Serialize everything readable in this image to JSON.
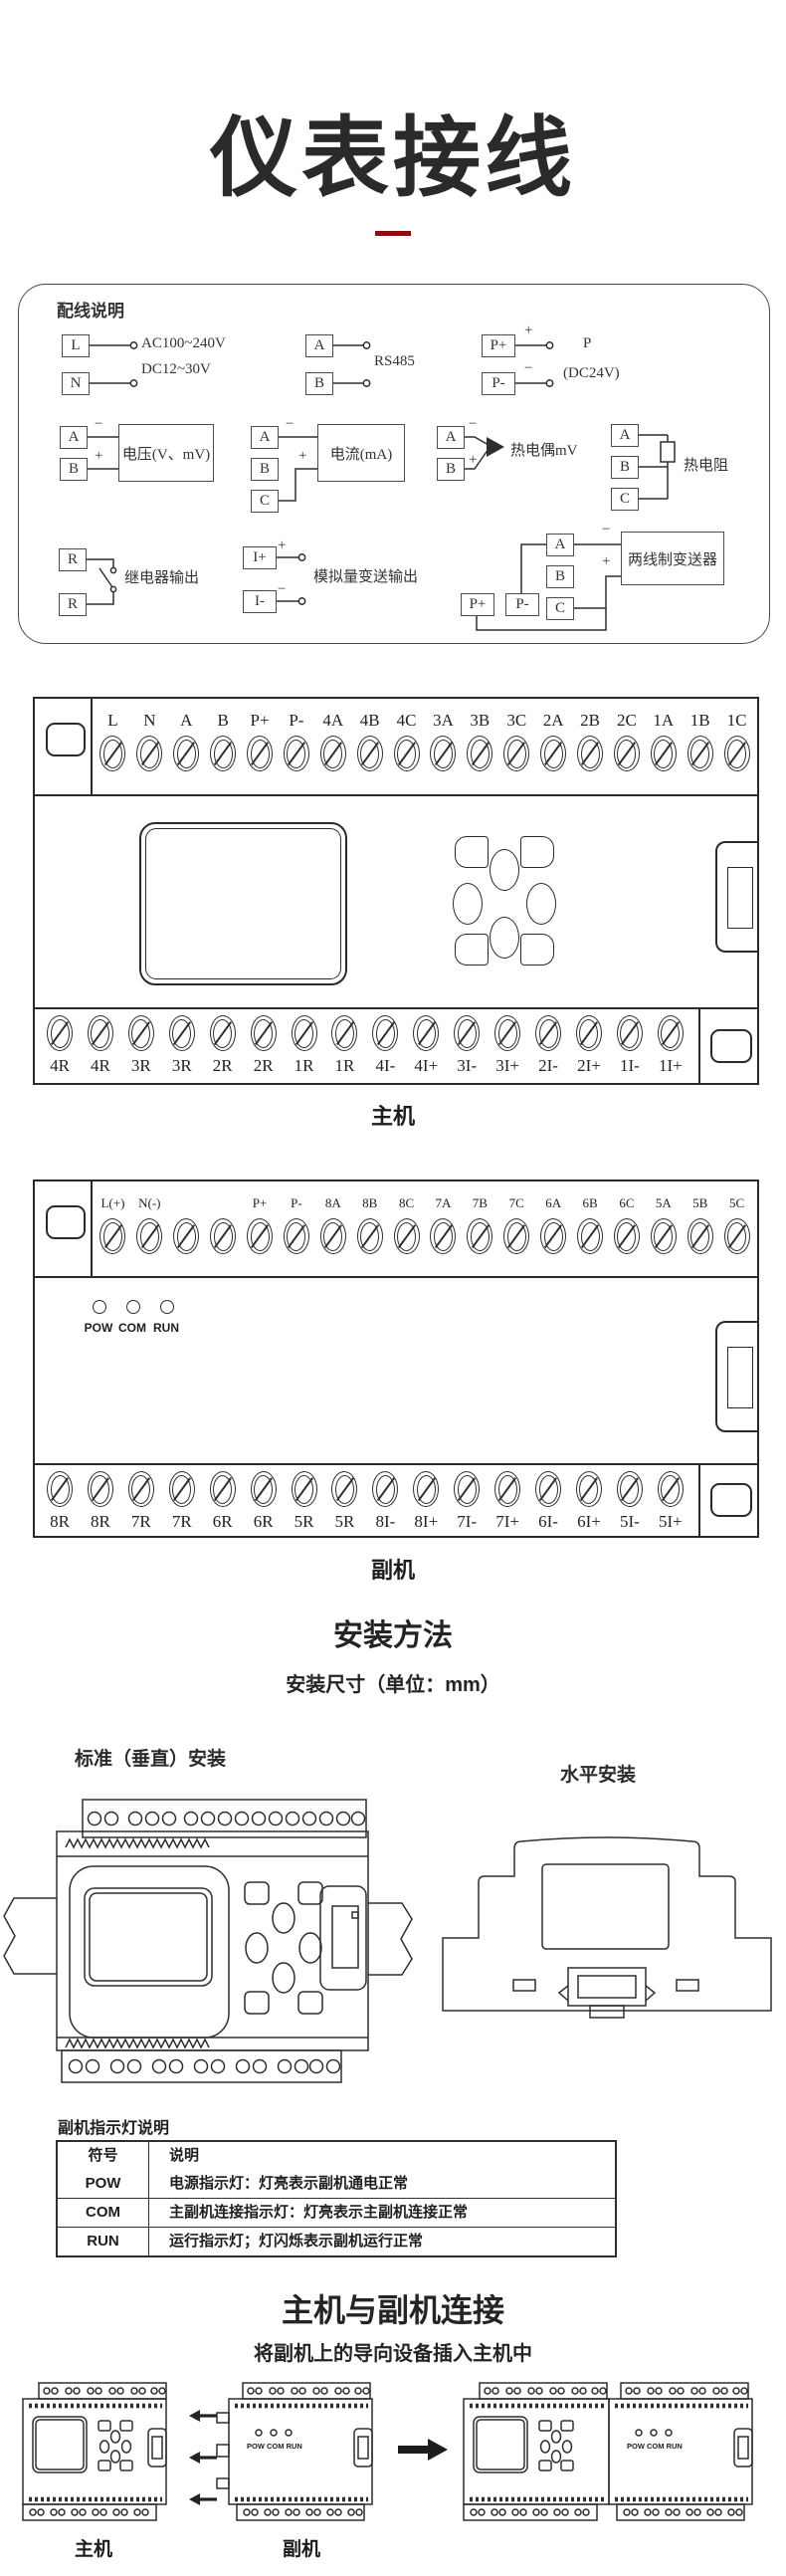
{
  "colors": {
    "accent_red": "#8e0c0c",
    "ink": "#2e2e2e"
  },
  "title": "仪表接线",
  "wiring_box": {
    "heading": "配线说明",
    "power": {
      "t1": "L",
      "t2": "N",
      "line1": "AC100~240V",
      "line2": "DC12~30V"
    },
    "rs485": {
      "t1": "A",
      "t2": "B",
      "label": "RS485"
    },
    "power24": {
      "t1": "P+",
      "t2": "P-",
      "plus": "+",
      "minus": "−",
      "label1": "P",
      "label2": "(DC24V)"
    },
    "voltage": {
      "t1": "A",
      "t2": "B",
      "minus": "−",
      "plus": "+",
      "label": "电压(V、mV)"
    },
    "current": {
      "t1": "A",
      "t2": "B",
      "t3": "C",
      "minus": "−",
      "plus": "+",
      "label": "电流(mA)"
    },
    "thermocouple": {
      "t1": "A",
      "t2": "B",
      "minus": "−",
      "plus": "+",
      "label": "热电偶mV"
    },
    "rtd": {
      "t1": "A",
      "t2": "B",
      "t3": "C",
      "label": "热电阻"
    },
    "relay": {
      "t1": "R",
      "t2": "R",
      "label": "继电器输出"
    },
    "analog_out": {
      "t1": "I+",
      "t2": "I-",
      "plus": "+",
      "minus": "−",
      "label": "模拟量变送输出"
    },
    "transmitter": {
      "tp1": "P+",
      "tp2": "P-",
      "t1": "A",
      "t2": "B",
      "t3": "C",
      "minus": "−",
      "plus": "+",
      "label": "两线制变送器"
    }
  },
  "main_unit": {
    "label": "主机",
    "top_terminals": [
      "L",
      "N",
      "A",
      "B",
      "P+",
      "P-",
      "4A",
      "4B",
      "4C",
      "3A",
      "3B",
      "3C",
      "2A",
      "2B",
      "2C",
      "1A",
      "1B",
      "1C"
    ],
    "bottom_terminals": [
      "4R",
      "4R",
      "3R",
      "3R",
      "2R",
      "2R",
      "1R",
      "1R",
      "4I-",
      "4I+",
      "3I-",
      "3I+",
      "2I-",
      "2I+",
      "1I-",
      "1I+"
    ]
  },
  "sub_unit": {
    "label": "副机",
    "top_terminals": [
      "L(+)",
      "N(-)",
      "",
      "",
      "P+",
      "P-",
      "8A",
      "8B",
      "8C",
      "7A",
      "7B",
      "7C",
      "6A",
      "6B",
      "6C",
      "5A",
      "5B",
      "5C"
    ],
    "leds": [
      "POW",
      "COM",
      "RUN"
    ],
    "bottom_terminals": [
      "8R",
      "8R",
      "7R",
      "7R",
      "6R",
      "6R",
      "5R",
      "5R",
      "8I-",
      "8I+",
      "7I-",
      "7I+",
      "6I-",
      "6I+",
      "5I-",
      "5I+"
    ]
  },
  "install": {
    "heading": "安装方法",
    "subheading": "安装尺寸（单位：mm）",
    "vertical_label": "标准（垂直）安装",
    "horizontal_label": "水平安装"
  },
  "indicator_table": {
    "heading": "副机指示灯说明",
    "col_symbol": "符号",
    "col_desc": "说明",
    "rows": [
      {
        "sym": "POW",
        "desc": "电源指示灯：灯亮表示副机通电正常"
      },
      {
        "sym": "COM",
        "desc": "主副机连接指示灯：灯亮表示主副机连接正常"
      },
      {
        "sym": "RUN",
        "desc": "运行指示灯；灯闪烁表示副机运行正常"
      }
    ]
  },
  "connection": {
    "heading": "主机与副机连接",
    "subheading": "将副机上的导向设备插入主机中",
    "main_label": "主机",
    "sub_label": "副机",
    "led_text": "POW COM RUN"
  }
}
